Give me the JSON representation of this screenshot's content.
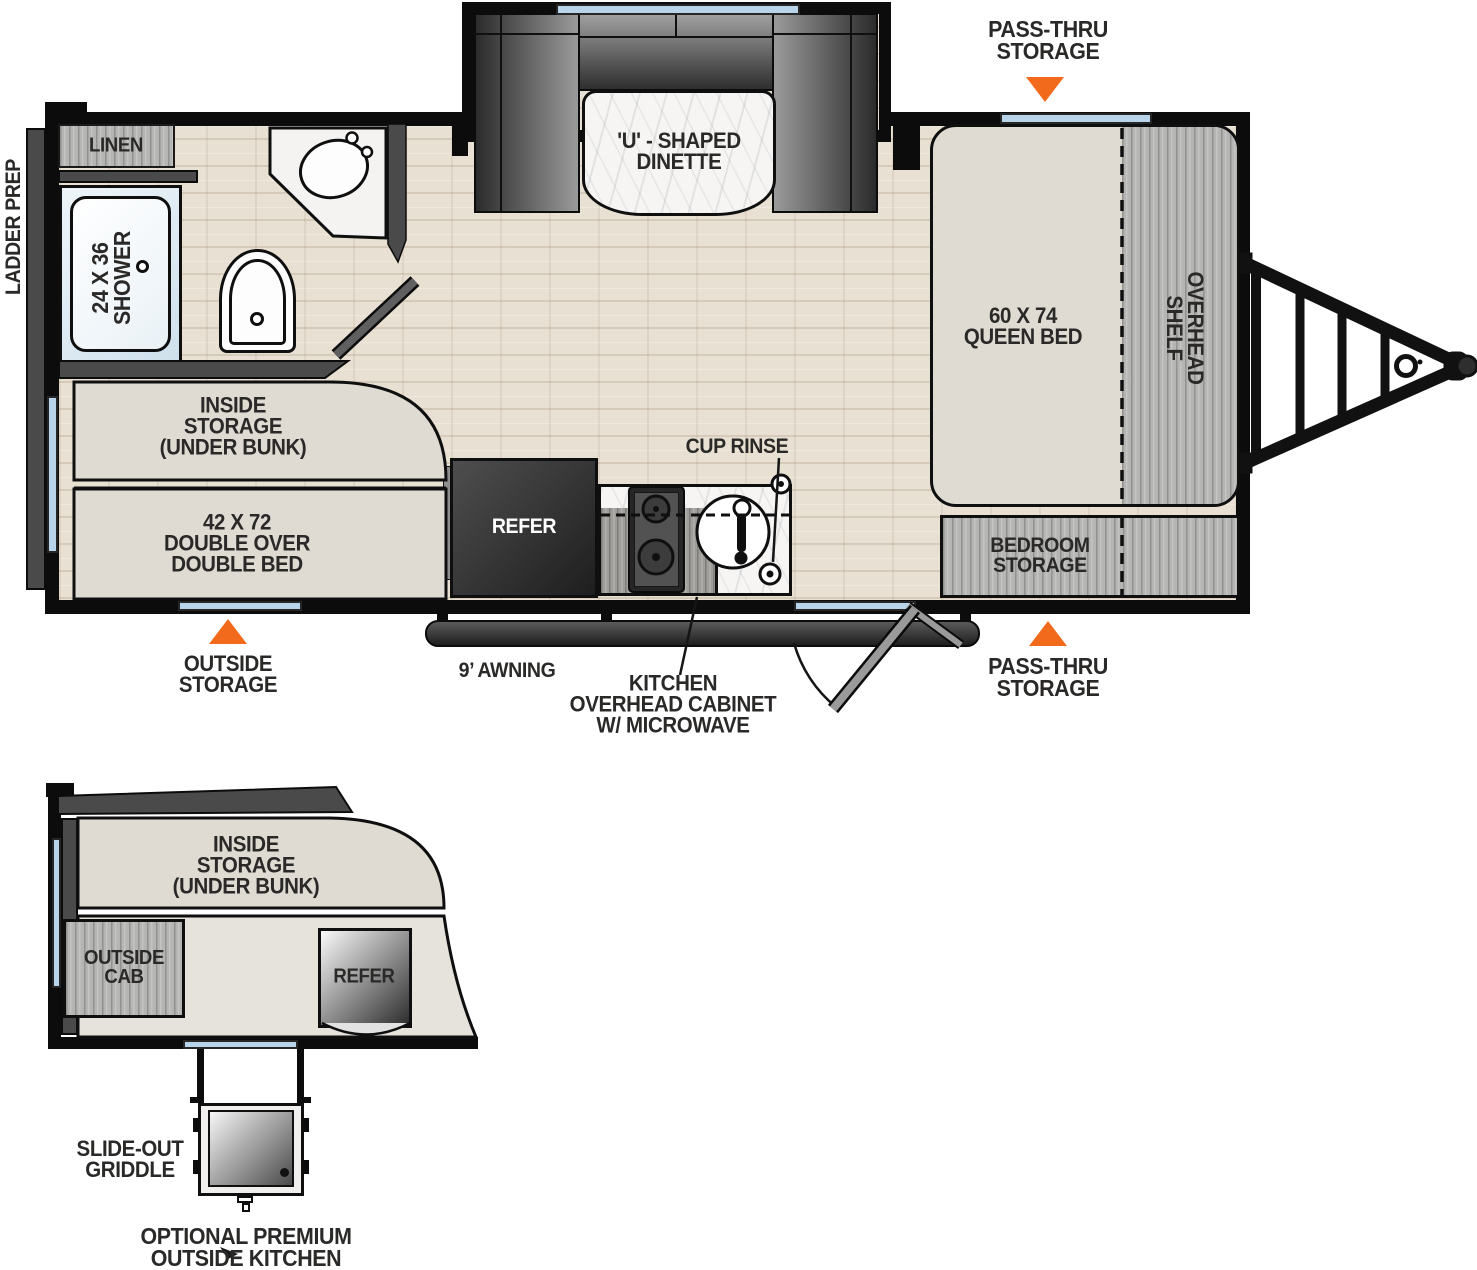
{
  "colors": {
    "accent_orange": "#f26b1d",
    "wall_black": "#0c0c0c",
    "window_blue": "#b8d4ea",
    "floor_tan": "#e8e0d2",
    "cabinet_gray": "#b5b5b3",
    "furniture_beige": "#dfdbd3"
  },
  "main_floorplan": {
    "exterior_callouts": {
      "pass_thru_storage_top": "PASS-THRU\nSTORAGE",
      "pass_thru_storage_bottom": "PASS-THRU\nSTORAGE",
      "outside_storage": "OUTSIDE\nSTORAGE",
      "awning": "9’ AWNING",
      "kitchen_overhead_cabinet": "KITCHEN\nOVERHEAD CABINET\nW/ MICROWAVE",
      "ladder_prep": "LADDER PREP"
    },
    "interior_labels": {
      "dinette": "'U' - SHAPED\nDINETTE",
      "queen_bed": "60 X 74\nQUEEN BED",
      "overhead_shelf": "OVERHEAD\nSHELF",
      "bedroom_storage": "BEDROOM\nSTORAGE",
      "inside_storage": "INSIDE\nSTORAGE\n(UNDER BUNK)",
      "double_bed": "42 X 72\nDOUBLE OVER\nDOUBLE BED",
      "refer": "REFER",
      "cup_rinse": "CUP RINSE",
      "shower": "24 X 36\nSHOWER",
      "linen": "LINEN"
    }
  },
  "outside_kitchen_detail": {
    "inside_storage": "INSIDE\nSTORAGE\n(UNDER BUNK)",
    "outside_cab": "OUTSIDE\nCAB",
    "refer": "REFER",
    "slide_out_griddle": "SLIDE-OUT\nGRIDDLE",
    "optional_premium_outside_kitchen": "OPTIONAL PREMIUM\nOUTSIDE KITCHEN"
  }
}
